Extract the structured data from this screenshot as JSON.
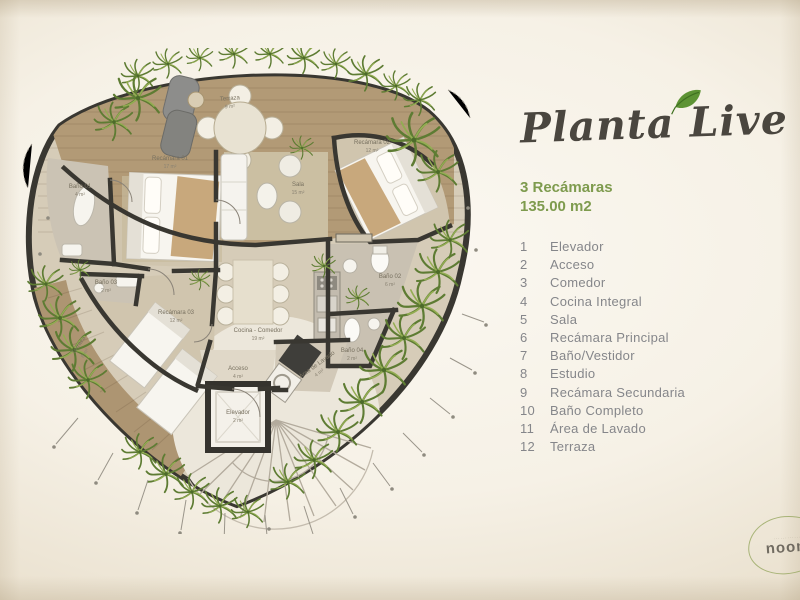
{
  "title": "Planta Live",
  "summary": {
    "bedrooms": "3 Recámaras",
    "area": "135.00 m2"
  },
  "legend": {
    "items": [
      {
        "num": "1",
        "label": "Elevador"
      },
      {
        "num": "2",
        "label": "Acceso"
      },
      {
        "num": "3",
        "label": "Comedor"
      },
      {
        "num": "4",
        "label": "Cocina Integral"
      },
      {
        "num": "5",
        "label": "Sala"
      },
      {
        "num": "6",
        "label": "Recámara Principal"
      },
      {
        "num": "7",
        "label": "Baño/Vestidor"
      },
      {
        "num": "8",
        "label": "Estudio"
      },
      {
        "num": "9",
        "label": "Recámara Secundaria"
      },
      {
        "num": "10",
        "label": "Baño Completo"
      },
      {
        "num": "11",
        "label": "Área de Lavado"
      },
      {
        "num": "12",
        "label": "Terraza"
      }
    ]
  },
  "plan": {
    "rooms": {
      "terraza_top": {
        "name": "Terraza",
        "area": "9 m²"
      },
      "terraza_left": {
        "name": "Terraza",
        "area": "8 m²"
      },
      "recamara1": {
        "name": "Recámara 01",
        "area": "17 m²"
      },
      "recamara2": {
        "name": "Recámara 02",
        "area": "12 m²"
      },
      "recamara3": {
        "name": "Recámara 03",
        "area": "12 m²"
      },
      "sala": {
        "name": "Sala",
        "area": "15 m²"
      },
      "cocina": {
        "name": "Cocina - Comedor",
        "area": "19 m²"
      },
      "bano1": {
        "name": "Baño 01",
        "area": "4 m²"
      },
      "bano2": {
        "name": "Baño 02",
        "area": "6 m²"
      },
      "bano3": {
        "name": "Baño 03",
        "area": "2 m²"
      },
      "bano4": {
        "name": "Baño 04",
        "area": "2 m²"
      },
      "acceso": {
        "name": "Acceso",
        "area": "4 m²"
      },
      "lavado": {
        "name": "Área de Lavado",
        "area": "4 m²"
      },
      "elevador": {
        "name": "Elevador",
        "area": "2 m²"
      }
    }
  },
  "logo": {
    "name": "noom",
    "tagline": "············"
  },
  "colors": {
    "accent_green": "#7e9b4e",
    "legend_gray": "#85868a",
    "title_ink": "#4a463f",
    "wall": "#393731",
    "wood": "#b29a76"
  }
}
